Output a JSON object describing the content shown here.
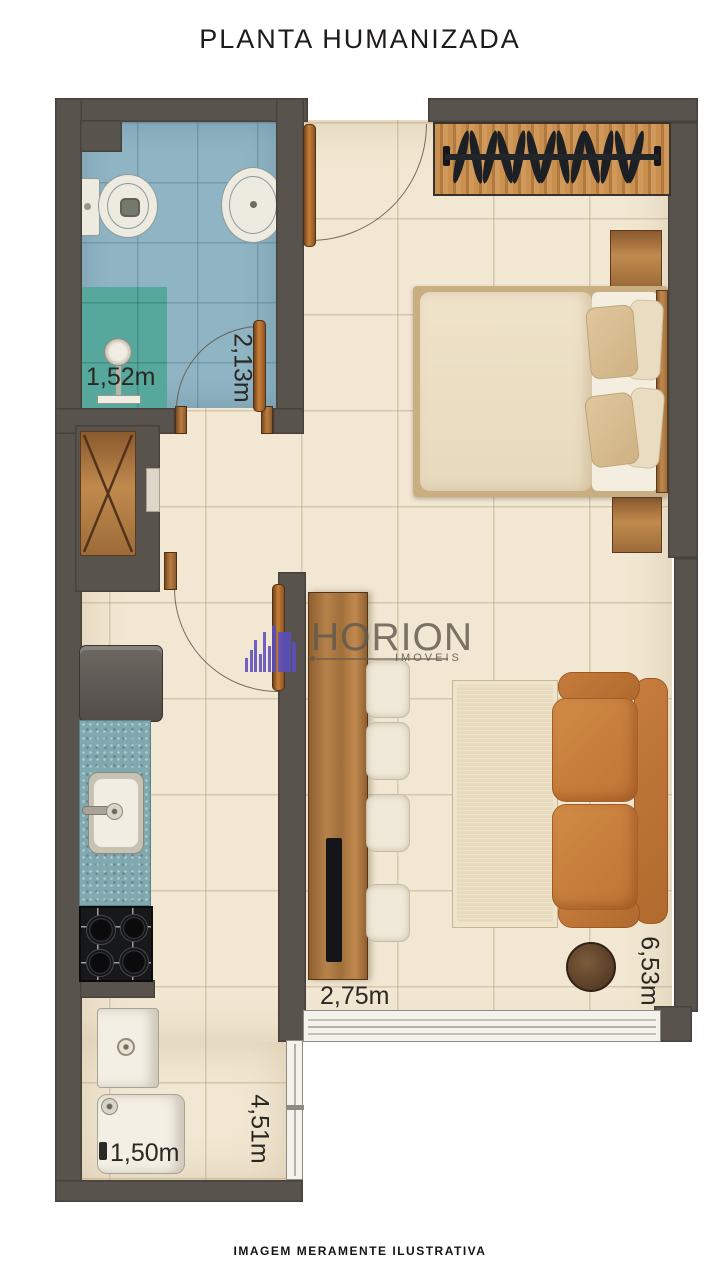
{
  "title": "PLANTA HUMANIZADA",
  "footer_disclaimer": "IMAGEM MERAMENTE ILUSTRATIVA",
  "watermark": {
    "brand": "HORION",
    "tagline": "IMOVEIS"
  },
  "dimensions": {
    "bathroom_width": "1,52m",
    "bathroom_length": "2,13m",
    "living_width": "2,75m",
    "living_length": "6,53m",
    "service_length": "4,51m",
    "service_width": "1,50m"
  },
  "colors": {
    "wall": "#59534E",
    "floor_tile": "#F1E7D2",
    "bathroom_tile": "#8FB4C3",
    "shower_box": "#57A89C",
    "kitchen_counter": "#7FA9AE",
    "wood": "#B5824A",
    "sofa": "#C8803E",
    "watermark_purple": "#5A4FBF",
    "watermark_gray": "#605850"
  }
}
